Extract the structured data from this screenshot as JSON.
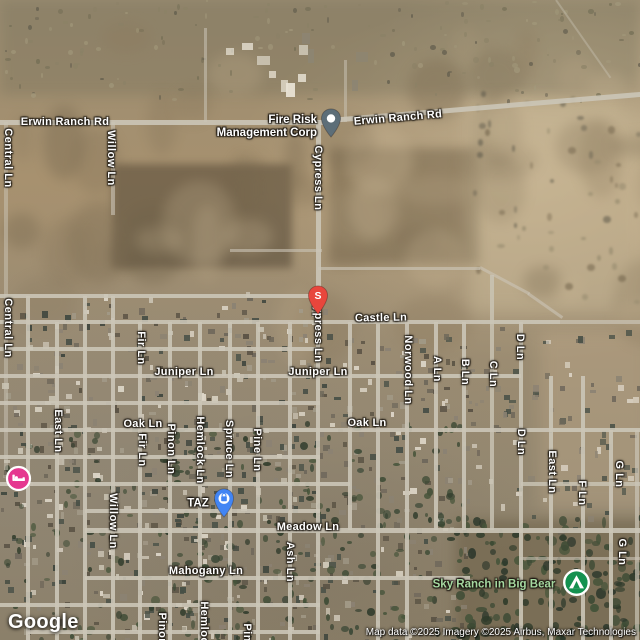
{
  "logo_text": "Google",
  "attribution_text": "Map data ©2025 Imagery ©2025 Airbus, Maxar Technologies",
  "colors": {
    "road": "#cbc5b7",
    "pin_gray": "#5d6e78",
    "pin_red": "#e8463c",
    "pin_blue": "#4285f4",
    "circle_pink": "#e5378f",
    "circle_green": "#149150",
    "label_white": "#ffffff",
    "label_green": "#a5d8a0"
  },
  "street_labels": [
    {
      "text": "Erwin Ranch Rd",
      "x": 65,
      "y": 122,
      "dir": "h",
      "rot": 0
    },
    {
      "text": "Erwin Ranch Rd",
      "x": 398,
      "y": 118,
      "dir": "h",
      "rot": -5
    },
    {
      "text": "Central Ln",
      "x": 8,
      "y": 158,
      "dir": "v"
    },
    {
      "text": "Willow Ln",
      "x": 111,
      "y": 158,
      "dir": "v"
    },
    {
      "text": "Cypress Ln",
      "x": 318,
      "y": 178,
      "dir": "v"
    },
    {
      "text": "Central Ln",
      "x": 8,
      "y": 328,
      "dir": "v"
    },
    {
      "text": "Cypress Ln",
      "x": 318,
      "y": 330,
      "dir": "v"
    },
    {
      "text": "Castle Ln",
      "x": 381,
      "y": 318,
      "dir": "h",
      "rot": -1
    },
    {
      "text": "Norwood Ln",
      "x": 408,
      "y": 370,
      "dir": "v"
    },
    {
      "text": "A Ln",
      "x": 437,
      "y": 369,
      "dir": "v"
    },
    {
      "text": "B Ln",
      "x": 465,
      "y": 372,
      "dir": "v"
    },
    {
      "text": "C Ln",
      "x": 493,
      "y": 374,
      "dir": "v"
    },
    {
      "text": "D Ln",
      "x": 520,
      "y": 347,
      "dir": "v"
    },
    {
      "text": "Fir Ln",
      "x": 141,
      "y": 348,
      "dir": "v"
    },
    {
      "text": "Juniper Ln",
      "x": 184,
      "y": 372,
      "dir": "h"
    },
    {
      "text": "Juniper Ln",
      "x": 318,
      "y": 372,
      "dir": "h"
    },
    {
      "text": "East Ln",
      "x": 58,
      "y": 431,
      "dir": "v"
    },
    {
      "text": "Oak Ln",
      "x": 143,
      "y": 424,
      "dir": "h"
    },
    {
      "text": "Oak Ln",
      "x": 367,
      "y": 423,
      "dir": "h"
    },
    {
      "text": "Fir Ln",
      "x": 142,
      "y": 450,
      "dir": "v"
    },
    {
      "text": "Pinon Ln",
      "x": 171,
      "y": 449,
      "dir": "v"
    },
    {
      "text": "Hemlock Ln",
      "x": 200,
      "y": 450,
      "dir": "v"
    },
    {
      "text": "Spruce Ln",
      "x": 229,
      "y": 449,
      "dir": "v"
    },
    {
      "text": "Pine Ln",
      "x": 257,
      "y": 450,
      "dir": "v"
    },
    {
      "text": "D Ln",
      "x": 521,
      "y": 442,
      "dir": "v"
    },
    {
      "text": "East Ln",
      "x": 552,
      "y": 472,
      "dir": "v"
    },
    {
      "text": "F Ln",
      "x": 582,
      "y": 493,
      "dir": "v"
    },
    {
      "text": "G Ln",
      "x": 619,
      "y": 474,
      "dir": "v"
    },
    {
      "text": "G Ln",
      "x": 622,
      "y": 552,
      "dir": "v"
    },
    {
      "text": "Willow Ln",
      "x": 113,
      "y": 521,
      "dir": "v"
    },
    {
      "text": "Meadow Ln",
      "x": 308,
      "y": 527,
      "dir": "h"
    },
    {
      "text": "Ash Ln",
      "x": 290,
      "y": 562,
      "dir": "v"
    },
    {
      "text": "Mahogany Ln",
      "x": 206,
      "y": 571,
      "dir": "h"
    },
    {
      "text": "Pinon Ln",
      "x": 162,
      "y": 638,
      "dir": "v"
    },
    {
      "text": "Hemlock Ln",
      "x": 204,
      "y": 635,
      "dir": "v"
    },
    {
      "text": "Pine Ln",
      "x": 247,
      "y": 645,
      "dir": "v"
    }
  ],
  "pois": [
    {
      "name": "fire-risk-management-corp",
      "label": "Fire Risk\nManagement Corp",
      "label_x": 317,
      "label_y": 127,
      "anchor": "right",
      "label_color": "#ffffff",
      "marker": "pin-gray",
      "mx": 331,
      "my": 138
    },
    {
      "name": "s-stop",
      "label": "",
      "marker": "pin-red-s",
      "marker_text": "S",
      "mx": 318,
      "my": 315
    },
    {
      "name": "taz",
      "label": "TAZ",
      "label_x": 198,
      "label_y": 504,
      "anchor": "center",
      "label_color": "#ffffff",
      "marker": "pin-blue-shopping",
      "mx": 224,
      "my": 518
    },
    {
      "name": "lodging",
      "label": "",
      "marker": "circle-pink-bed",
      "mx": 18,
      "my": 478
    },
    {
      "name": "sky-ranch-in-big-bear",
      "label": "Sky Ranch in Big Bear",
      "label_x": 494,
      "label_y": 585,
      "anchor": "center",
      "label_color": "#a5d8a0",
      "marker": "circle-green-tent",
      "mx": 576,
      "my": 582
    }
  ],
  "roads": {
    "v": [
      {
        "x": 6,
        "y1": 122,
        "y2": 470,
        "o": 0.5
      },
      {
        "x": 28,
        "y1": 296,
        "y2": 640
      },
      {
        "x": 57,
        "y1": 322,
        "y2": 640
      },
      {
        "x": 85,
        "y1": 296,
        "y2": 640
      },
      {
        "x": 113,
        "y1": 122,
        "y2": 215,
        "o": 0.6
      },
      {
        "x": 113,
        "y1": 296,
        "y2": 640
      },
      {
        "x": 140,
        "y1": 322,
        "y2": 640
      },
      {
        "x": 170,
        "y1": 322,
        "y2": 640
      },
      {
        "x": 200,
        "y1": 322,
        "y2": 640
      },
      {
        "x": 230,
        "y1": 322,
        "y2": 640
      },
      {
        "x": 258,
        "y1": 322,
        "y2": 640
      },
      {
        "x": 290,
        "y1": 322,
        "y2": 640
      },
      {
        "x": 318,
        "y1": 120,
        "y2": 326,
        "w": 5
      },
      {
        "x": 318,
        "y1": 322,
        "y2": 640
      },
      {
        "x": 350,
        "y1": 322,
        "y2": 530
      },
      {
        "x": 378,
        "y1": 322,
        "y2": 640
      },
      {
        "x": 407,
        "y1": 322,
        "y2": 640
      },
      {
        "x": 436,
        "y1": 322,
        "y2": 530
      },
      {
        "x": 464,
        "y1": 322,
        "y2": 530
      },
      {
        "x": 492,
        "y1": 275,
        "y2": 530,
        "o": 0.8
      },
      {
        "x": 521,
        "y1": 322,
        "y2": 640
      },
      {
        "x": 551,
        "y1": 376,
        "y2": 640
      },
      {
        "x": 583,
        "y1": 376,
        "y2": 640
      },
      {
        "x": 611,
        "y1": 430,
        "y2": 640
      },
      {
        "x": 637,
        "y1": 430,
        "y2": 640,
        "o": 0.7
      },
      {
        "x": 205,
        "y1": 28,
        "y2": 122,
        "w": 3,
        "o": 0.55
      },
      {
        "x": 345,
        "y1": 60,
        "y2": 122,
        "w": 3,
        "o": 0.5
      }
    ],
    "h": [
      {
        "y": 122,
        "x1": 0,
        "x2": 332,
        "w": 5
      },
      {
        "y": 250,
        "x1": 230,
        "x2": 322,
        "w": 3,
        "o": 0.6
      },
      {
        "y": 268,
        "x1": 318,
        "x2": 480,
        "w": 3,
        "o": 0.65
      },
      {
        "y": 296,
        "x1": 0,
        "x2": 320
      },
      {
        "y": 322,
        "x1": 0,
        "x2": 560,
        "w": 4
      },
      {
        "y": 322,
        "x1": 560,
        "x2": 640,
        "o": 0.7
      },
      {
        "y": 349,
        "x1": 0,
        "x2": 320
      },
      {
        "y": 376,
        "x1": 0,
        "x2": 521
      },
      {
        "y": 403,
        "x1": 0,
        "x2": 320
      },
      {
        "y": 430,
        "x1": 0,
        "x2": 640
      },
      {
        "y": 457,
        "x1": 0,
        "x2": 320
      },
      {
        "y": 484,
        "x1": 0,
        "x2": 350
      },
      {
        "y": 484,
        "x1": 521,
        "x2": 640,
        "o": 0.8
      },
      {
        "y": 511,
        "x1": 85,
        "x2": 320
      },
      {
        "y": 530,
        "x1": 85,
        "x2": 640,
        "w": 5
      },
      {
        "y": 558,
        "x1": 520,
        "x2": 640,
        "w": 3,
        "o": 0.6
      },
      {
        "y": 578,
        "x1": 85,
        "x2": 470
      },
      {
        "y": 605,
        "x1": 0,
        "x2": 320
      },
      {
        "y": 632,
        "x1": 28,
        "x2": 320
      }
    ],
    "t": [
      {
        "x": 330,
        "y": 120,
        "len": 315,
        "rot": -4.8,
        "w": 5
      },
      {
        "x": 480,
        "y": 267,
        "len": 56,
        "rot": 28,
        "w": 3,
        "o": 0.6
      },
      {
        "x": 528,
        "y": 293,
        "len": 42,
        "rot": 35,
        "w": 3,
        "o": 0.6
      },
      {
        "x": 556,
        "y": 0,
        "len": 95,
        "rot": 55,
        "w": 2,
        "o": 0.4
      }
    ]
  }
}
